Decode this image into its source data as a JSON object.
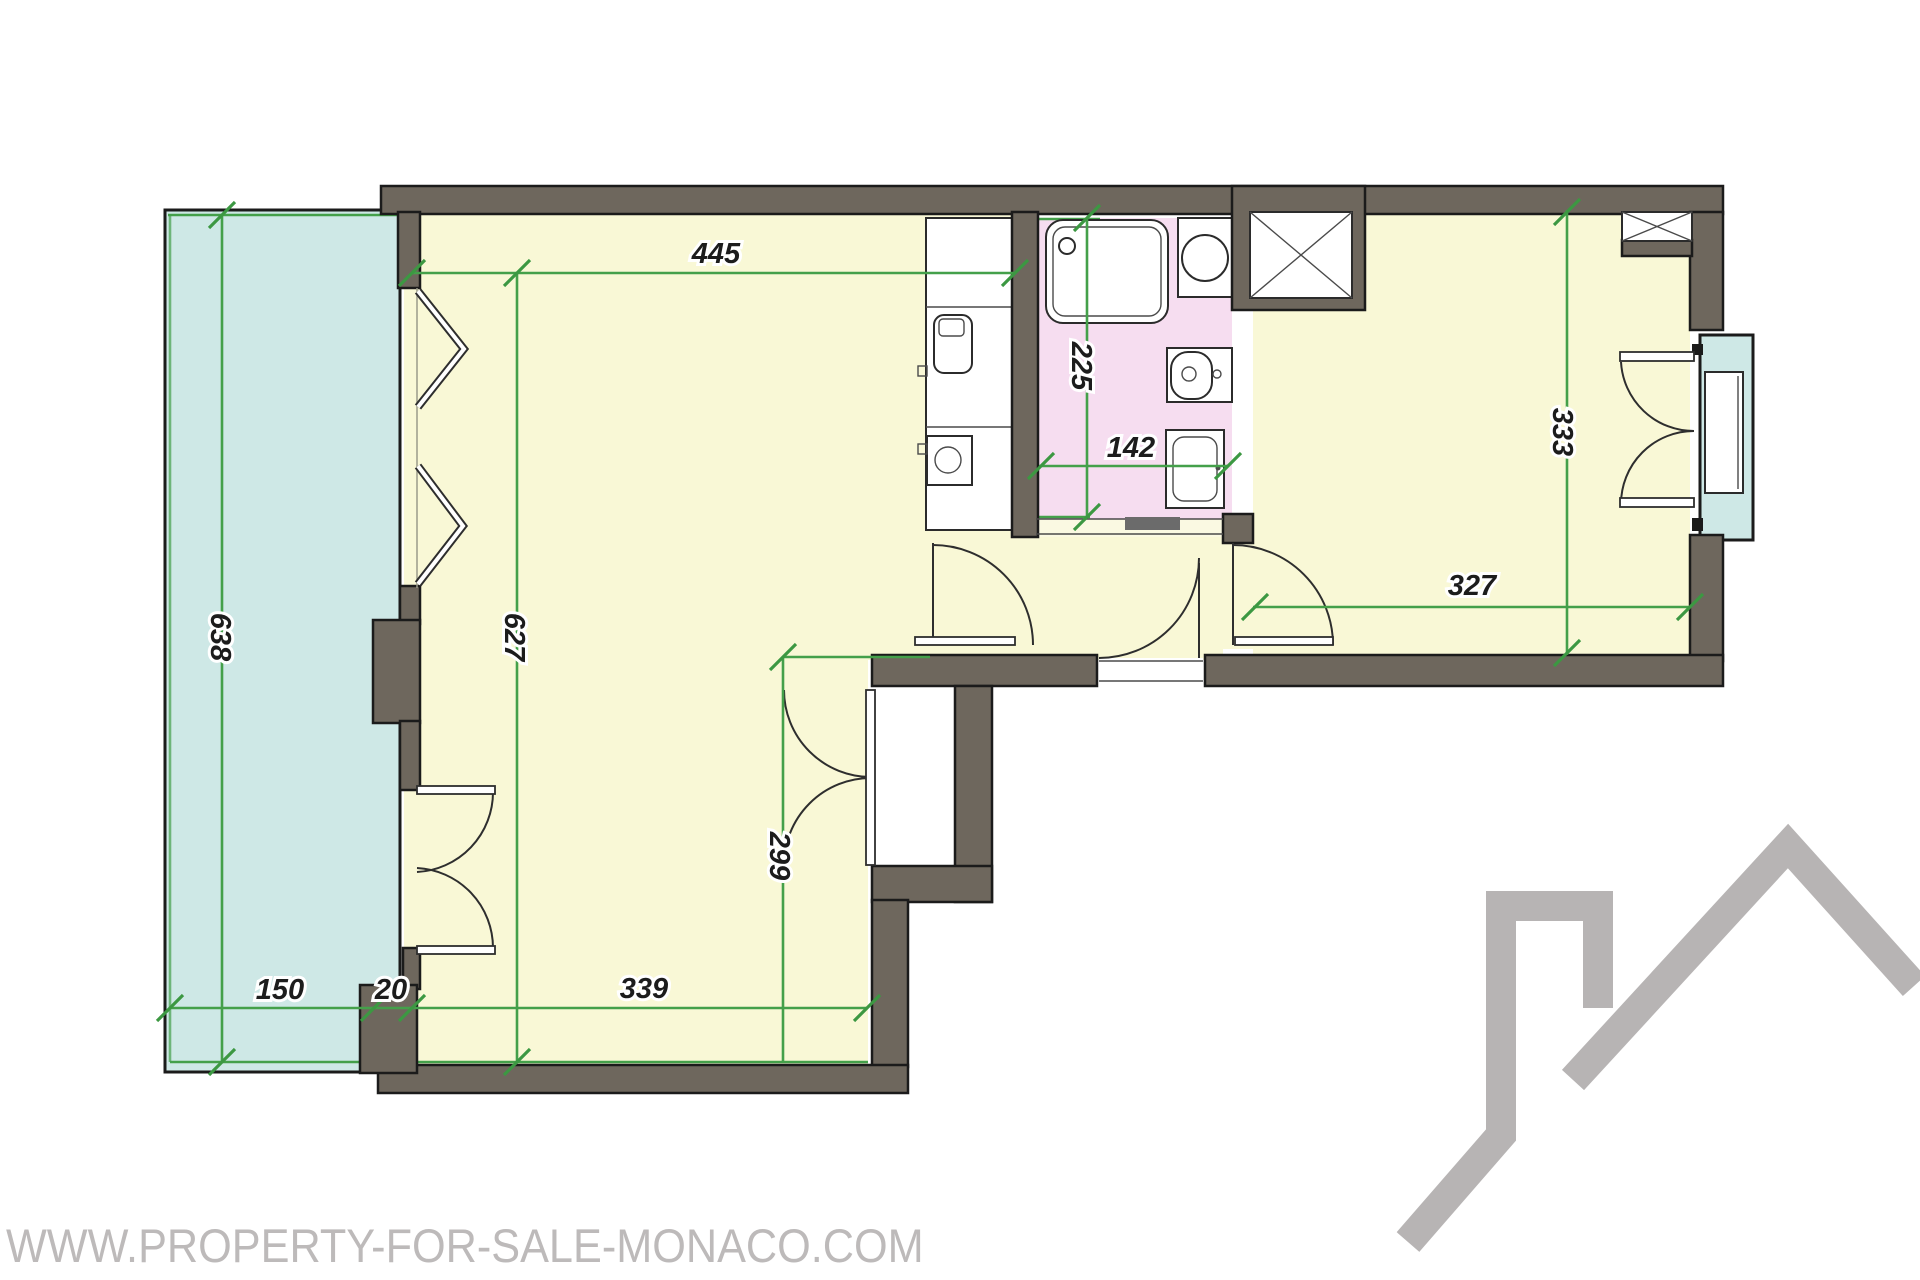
{
  "watermark": "WWW.PROPERTY-FOR-SALE-MONACO.COM",
  "dimensions": {
    "living_top_width": "445",
    "living_height": "627",
    "terrace_height": "638",
    "terrace_width": "150",
    "wall_gap": "20",
    "living_bottom_width": "339",
    "living_lower_height": "299",
    "bathroom_height": "225",
    "bathroom_width": "142",
    "bedroom_height": "333",
    "bedroom_width": "327"
  },
  "colors": {
    "wall": "#6e675d",
    "floor": "#f9f8d6",
    "terrace": "#cee8e6",
    "bathroom": "#f6ddf0",
    "dimension_green": "#44a04a",
    "watermark_gray": "#bdbaba",
    "logo_gray": "#b7b4b4"
  }
}
